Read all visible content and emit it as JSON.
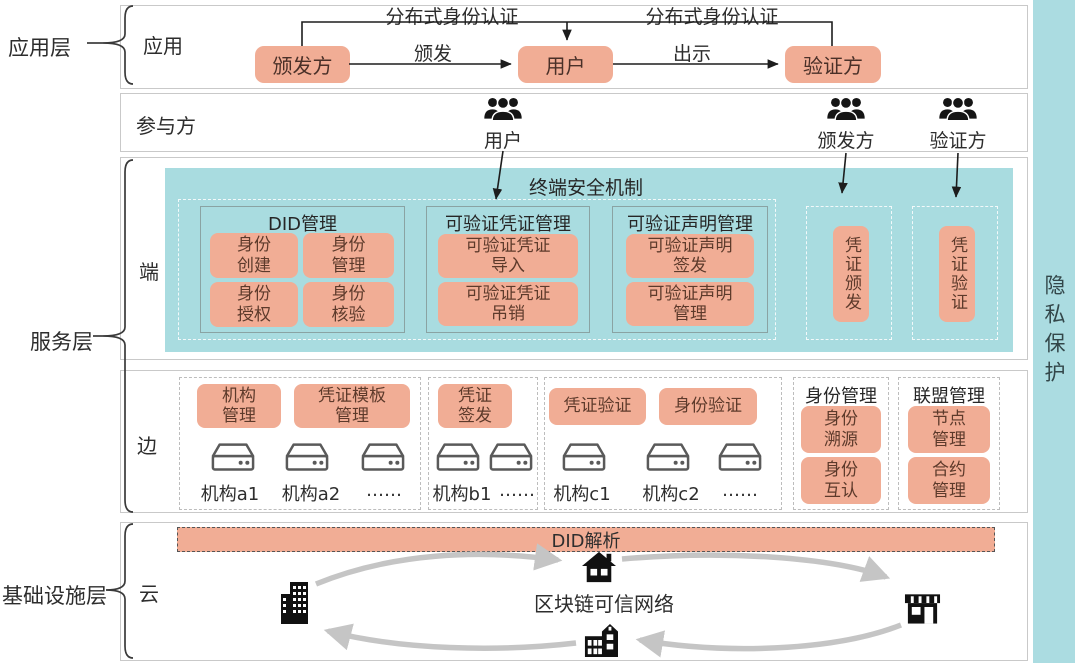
{
  "privacy": {
    "label": "隐私保护"
  },
  "layers": [
    {
      "label": "应用层"
    },
    {
      "label": "服务层"
    },
    {
      "label": "基础设施层"
    }
  ],
  "app_row": {
    "label": "应用",
    "issuer": "颁发方",
    "user": "用户",
    "verifier": "验证方",
    "issue_arrow": "颁发",
    "present_arrow": "出示",
    "auth_left": "分布式身份认证",
    "auth_right": "分布式身份认证"
  },
  "participants_row": {
    "label": "参与方",
    "user": "用户",
    "issuer": "颁发方",
    "verifier": "验证方"
  },
  "terminal_row": {
    "label": "端",
    "security_title": "终端安全机制",
    "did": {
      "title": "DID管理",
      "items": [
        "身份\n创建",
        "身份\n管理",
        "身份\n授权",
        "身份\n核验"
      ]
    },
    "vc": {
      "title": "可验证凭证管理",
      "items": [
        "可验证凭证\n导入",
        "可验证凭证\n吊销"
      ]
    },
    "vp": {
      "title": "可验证声明管理",
      "items": [
        "可验证声明\n签发",
        "可验证声明\n管理"
      ]
    },
    "issue_box": "凭证颁发",
    "verify_box": "凭证验证"
  },
  "edge_row": {
    "label": "边",
    "cluster_a": {
      "pills": [
        "机构\n管理",
        "凭证模板\n管理"
      ],
      "servers": [
        "机构a1",
        "机构a2",
        "……"
      ]
    },
    "cluster_b": {
      "pills": [
        "凭证\n签发"
      ],
      "servers": [
        "机构b1",
        "……"
      ]
    },
    "cluster_c": {
      "pills": [
        "凭证验证",
        "身份验证"
      ],
      "servers": [
        "机构c1",
        "机构c2",
        "……"
      ]
    },
    "identity_group": {
      "title": "身份管理",
      "items": [
        "身份\n溯源",
        "身份\n互认"
      ]
    },
    "federation_group": {
      "title": "联盟管理",
      "items": [
        "节点\n管理",
        "合约\n管理"
      ]
    }
  },
  "cloud_row": {
    "label": "云",
    "did_resolution": "DID解析",
    "network": "区块链可信网络"
  },
  "colors": {
    "teal": "#a9dce0",
    "salmon": "#f1ad95",
    "pill_text": "#5d3a2b",
    "arrow_gray": "#c5c5c5",
    "border_gray": "#c9c9c9"
  }
}
